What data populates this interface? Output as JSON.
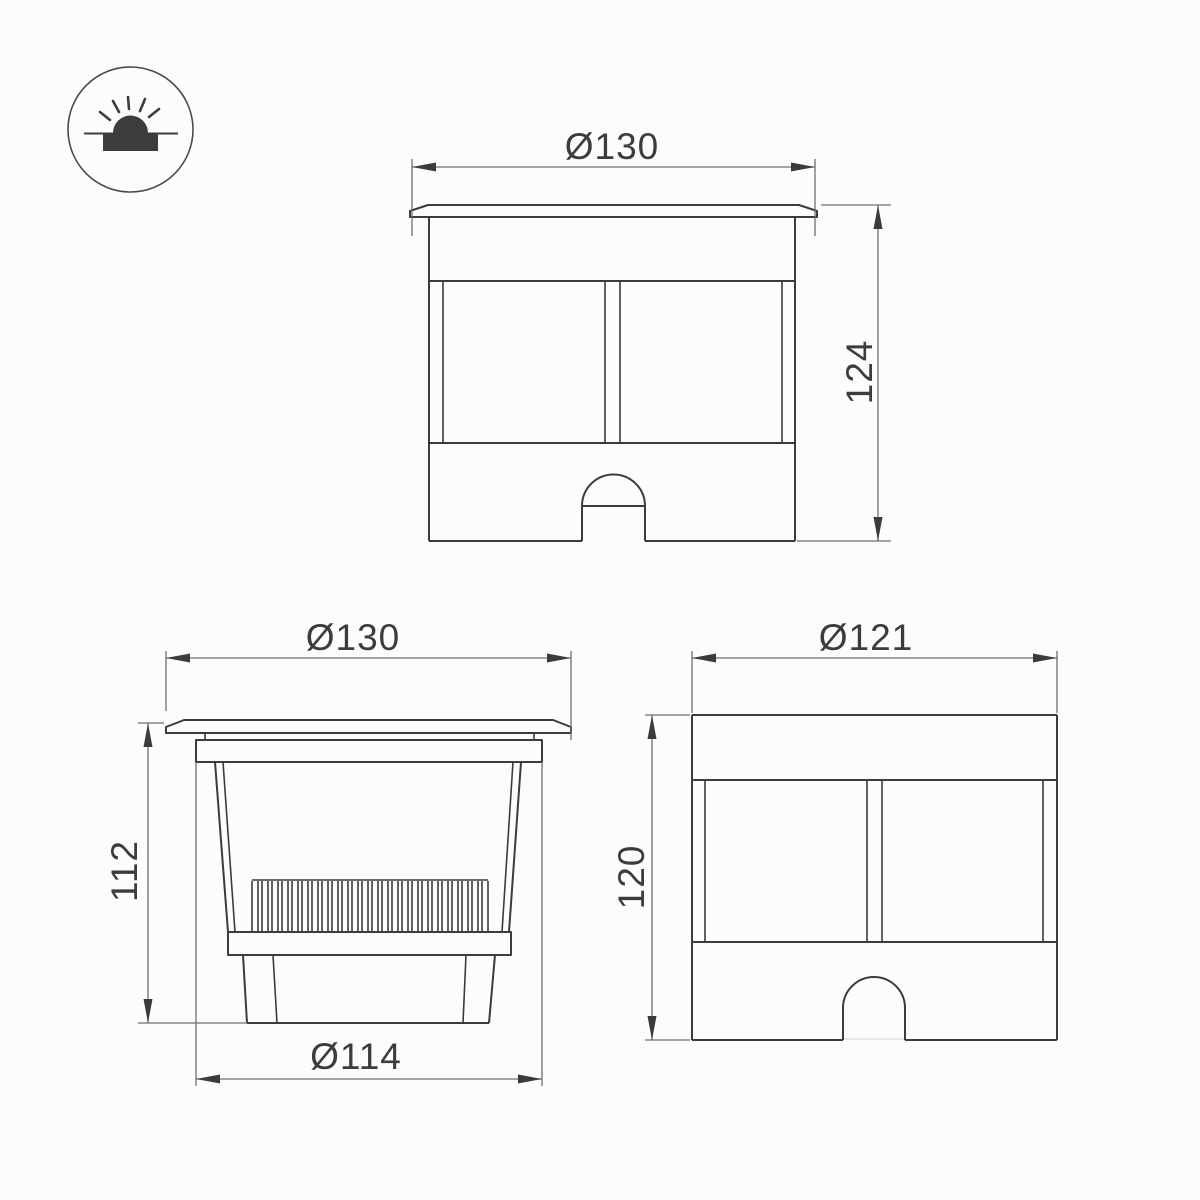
{
  "colors": {
    "background": "#fcfcfc",
    "object_line": "#3b3b3b",
    "dimension_line": "#6f6f6f",
    "icon_fill": "#3d3d3d"
  },
  "icon": {
    "inground_light_icon": "recessed-ground-light (filled dome with rays over ground line and recessed box)"
  },
  "views": {
    "front": {
      "width_dim": "Ø130",
      "height_dim": "124"
    },
    "section": {
      "width_dim": "Ø130",
      "height_dim": "112",
      "body_dim": "Ø114"
    },
    "housing": {
      "width_dim": "Ø121",
      "height_dim": "120"
    }
  }
}
